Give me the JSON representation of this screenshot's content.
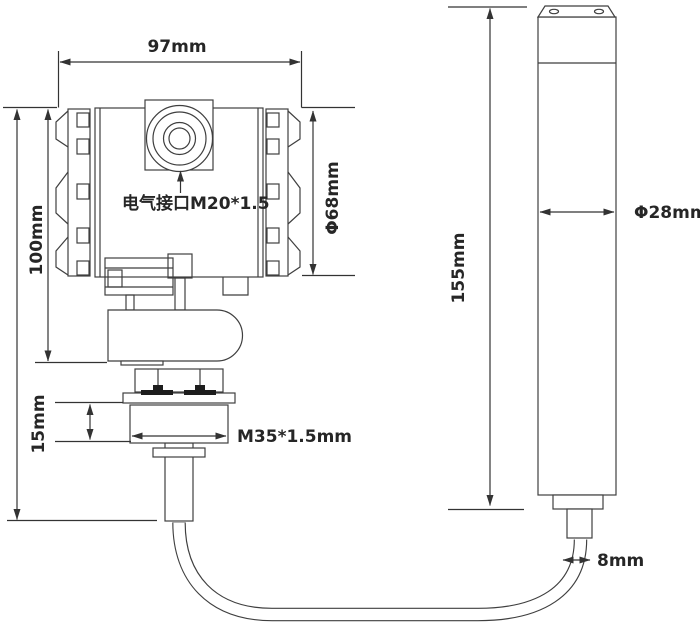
{
  "title": "level-transmitter-dimension-drawing",
  "labels": {
    "housing_width": "97mm",
    "housing_height": "100mm",
    "housing_diameter": "Φ68mm",
    "electrical_port": "电气接口M20*1.5",
    "thread_height": "15mm",
    "thread_spec": "M35*1.5mm",
    "probe_length": "155mm",
    "probe_diameter": "Φ28mm",
    "cable_diameter": "8mm"
  },
  "colors": {
    "background": "#ffffff",
    "line": "#3f3f3f",
    "text": "#262626"
  }
}
